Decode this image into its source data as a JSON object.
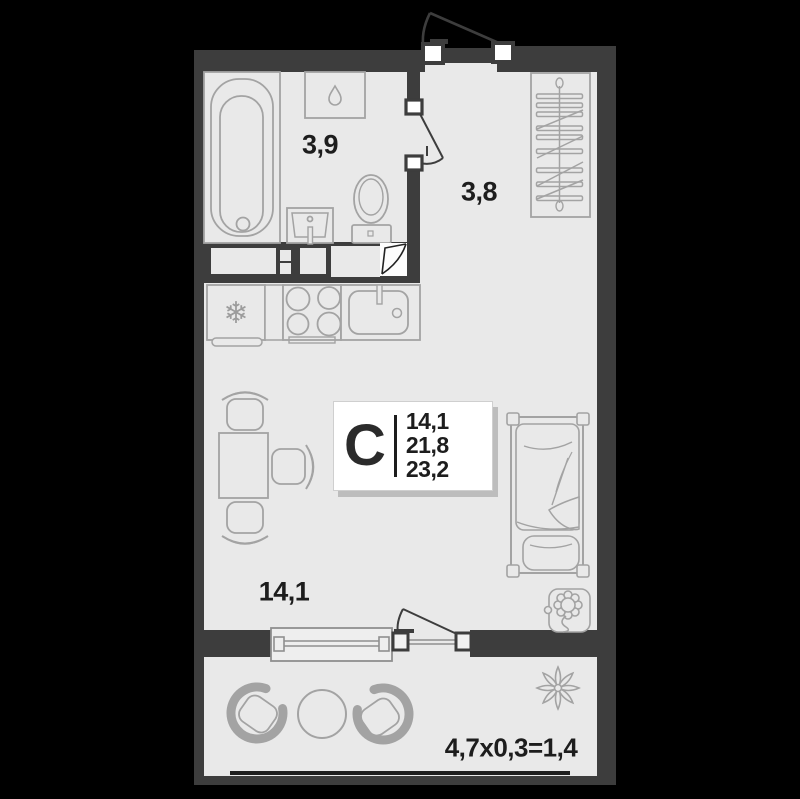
{
  "plan": {
    "title": "studio-apartment-floor-plan",
    "unit_card": {
      "type_letter": "С",
      "areas": [
        "14,1",
        "21,8",
        "23,2"
      ]
    },
    "rooms": {
      "bathroom": {
        "label": "3,9"
      },
      "hallway": {
        "label": "3,8"
      },
      "living": {
        "label": "14,1"
      },
      "balcony": {
        "label": "4,7x0,3=1,4"
      }
    }
  },
  "icons": {
    "fridge_glyph": "❄"
  },
  "colors": {
    "background": "#000000",
    "wall": "#3d3d3d",
    "floor": "#e9e9e9",
    "furniture_stroke": "#a3a3a3",
    "text": "#1d1d1d",
    "card_bg": "#ffffff",
    "card_shadow": "#bdbdbd"
  }
}
